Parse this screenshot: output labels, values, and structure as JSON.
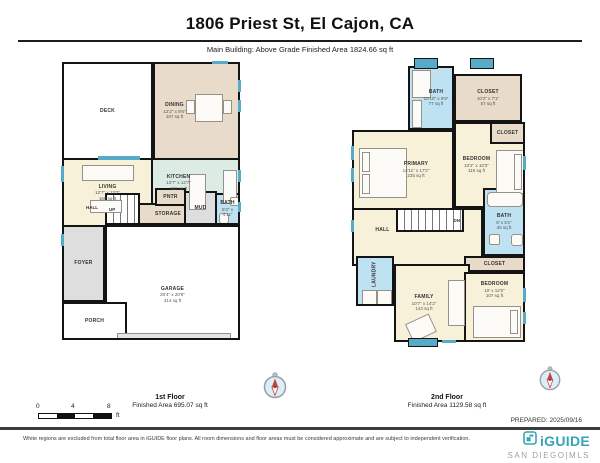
{
  "header": {
    "title": "1806 Priest St, El Cajon, CA",
    "subtitle": "Main Building: Above Grade Finished Area 1824.66 sq ft"
  },
  "floors": [
    {
      "name": "1st Floor",
      "area_label": "Finished Area 695.07 sq ft",
      "rooms": {
        "deck": {
          "name": "DECK"
        },
        "dining": {
          "name": "DINING",
          "dims": "12'2\" x 9'6\"",
          "area": "107 sq ft"
        },
        "living": {
          "name": "LIVING",
          "dims": "12'7\" x 13'3\"",
          "area": "160 sq ft"
        },
        "kitchen": {
          "name": "KITCHEN",
          "dims": "13'7\" x 12'7\"",
          "area": "162 sq ft"
        },
        "pantry": {
          "name": "PNTR"
        },
        "mud": {
          "name": "MUD"
        },
        "storage": {
          "name": "STORAGE"
        },
        "bath": {
          "name": "BATH",
          "dims": "5'3\" x 4'11\""
        },
        "hall": {
          "name": "HALL"
        },
        "up": {
          "name": "UP"
        },
        "foyer": {
          "name": "FOYER"
        },
        "porch": {
          "name": "PORCH"
        },
        "garage": {
          "name": "GARAGE",
          "dims": "20'4\" x 20'8\"",
          "area": "414 sq ft"
        }
      }
    },
    {
      "name": "2nd Floor",
      "area_label": "Finished Area 1129.58 sq ft",
      "rooms": {
        "bath1": {
          "name": "BATH",
          "dims": "10'10\" x 9'9\"",
          "area": "77 sq ft"
        },
        "closet1": {
          "name": "CLOSET",
          "dims": "10'2\" x 7'1\"",
          "area": "57 sq ft"
        },
        "closet2": {
          "name": "CLOSET"
        },
        "primary": {
          "name": "PRIMARY",
          "dims": "14'11\" x 17'2\"",
          "area": "225 sq ft"
        },
        "bedroom1": {
          "name": "BEDROOM",
          "dims": "10'2\" x 10'3\"",
          "area": "119 sq ft"
        },
        "dn": {
          "name": "DN"
        },
        "hall": {
          "name": "HALL"
        },
        "bath2": {
          "name": "BATH",
          "dims": "8' x 5'1\"",
          "area": "40 sq ft"
        },
        "closet3": {
          "name": "CLOSET"
        },
        "laundry": {
          "name": "LAUNDRY"
        },
        "family": {
          "name": "FAMILY",
          "dims": "10'7\" x 14'2\"",
          "area": "143 sq ft"
        },
        "bedroom2": {
          "name": "BEDROOM",
          "dims": "10' x 12'5\"",
          "area": "107 sq ft"
        }
      }
    }
  ],
  "scale_bar": {
    "ticks": [
      "0",
      "4",
      "8"
    ],
    "unit": "ft"
  },
  "prepared": "PREPARED: 2025/09/16",
  "footer": {
    "disclaimer": "White regions are excluded from total floor area in iGUIDE floor plans. All room dimensions and floor areas must be considered approximate and are subject to independent verification.",
    "logo": "iGUIDE",
    "logo_sub": "SAN DIEGO|MLS"
  },
  "colors": {
    "wall": "#141414",
    "window": "#58aac9",
    "room_yellow": "#f8f1da",
    "room_tan": "#e8dbc9",
    "room_teal": "#dcece4",
    "room_blue": "#bfe2f2",
    "room_gray": "#dedede",
    "logo_teal": "#35a4b8"
  }
}
